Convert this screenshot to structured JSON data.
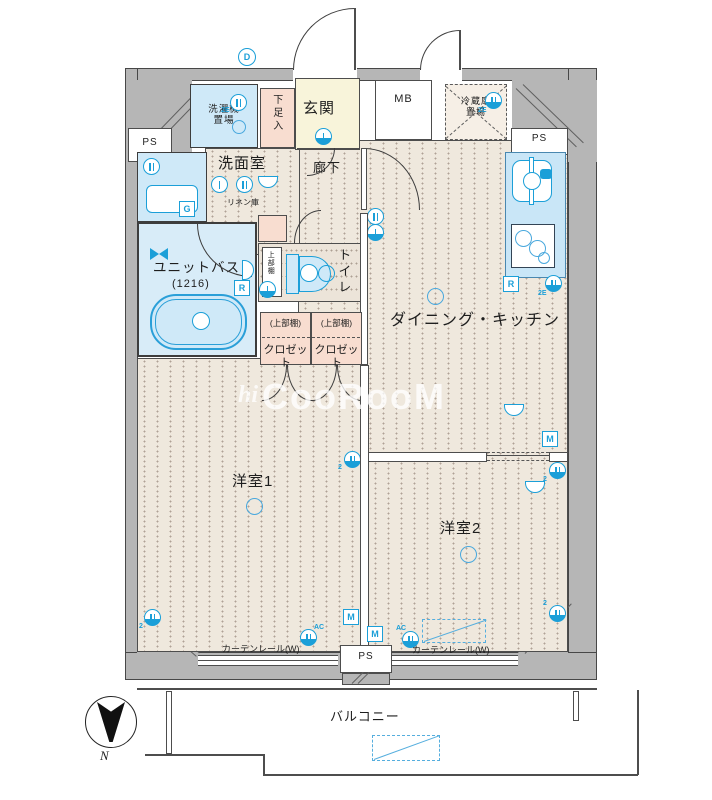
{
  "plan": {
    "watermark_prefix": "hi",
    "watermark": "CooRooM",
    "rooms": {
      "ps": "PS",
      "laundry": "洗濯機\n置場",
      "shoe_box": "下足入",
      "entrance": "玄関",
      "meter_box": "MB",
      "fridge": "冷蔵庫\n置場",
      "washroom": "洗面室",
      "hallway": "廊下",
      "linen": "リネン庫",
      "unit_bath": "ユニットバス",
      "unit_bath_size": "(1216)",
      "toilet": "トイレ",
      "upper_shelf": "(上部棚)",
      "upper_shelf_plain": "上部棚",
      "closet": "クロゼット",
      "dining_kitchen": "ダイニング・キッチン",
      "bedroom1": "洋室1",
      "bedroom2": "洋室2",
      "curtain_rail": "カーテンレール(W)",
      "balcony": "バルコニー",
      "north": "N"
    },
    "symbols": {
      "m": "M",
      "r": "R",
      "d": "D",
      "g": "G",
      "ac": "AC",
      "outlet_2e": "2E",
      "num2": "2"
    },
    "colors": {
      "fixture_blue": "#1b9fd8",
      "wall_gray": "#b6b6b6",
      "floor_beige": "#efe8dd",
      "entrance_yellow": "#f8f4da",
      "closet_pink": "#f8ddd0",
      "bath_blue": "#d8ecf8",
      "kitchen_blue": "#c9e6f7"
    }
  }
}
